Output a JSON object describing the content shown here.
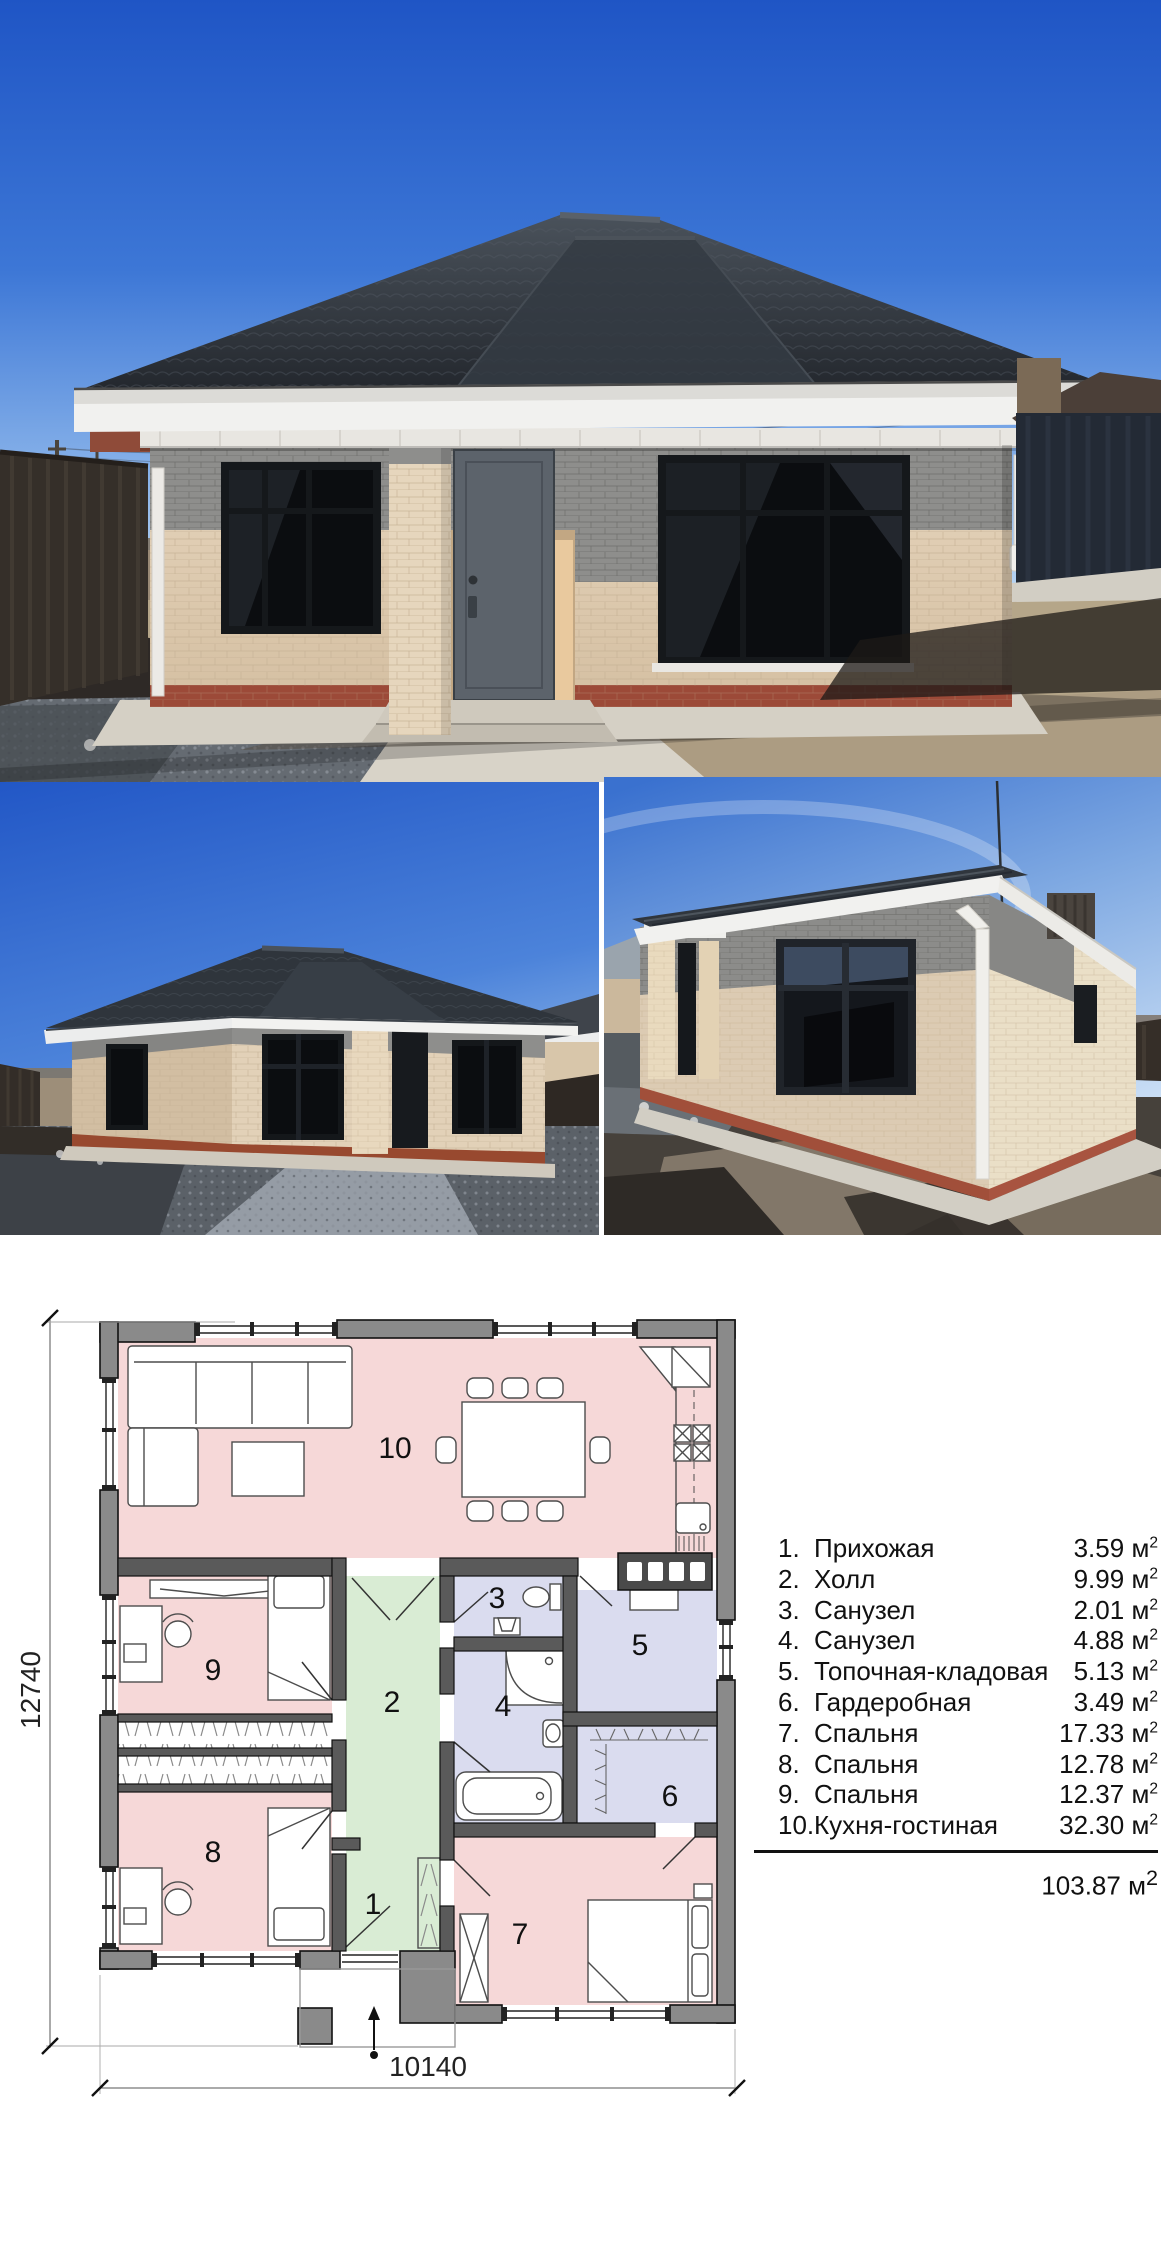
{
  "plan": {
    "room_numbers": [
      "1",
      "2",
      "3",
      "4",
      "5",
      "6",
      "7",
      "8",
      "9",
      "10"
    ],
    "dimensions": {
      "width_label": "10140",
      "height_label": "12740"
    }
  },
  "legend": {
    "items": [
      {
        "num": "1.",
        "name": "Прихожая",
        "area": "3.59"
      },
      {
        "num": "2.",
        "name": "Холл",
        "area": "9.99"
      },
      {
        "num": "3.",
        "name": "Санузел",
        "area": "2.01"
      },
      {
        "num": "4.",
        "name": "Санузел",
        "area": "4.88"
      },
      {
        "num": "5.",
        "name": "Топочная-кладовая",
        "area": "5.13"
      },
      {
        "num": "6.",
        "name": "Гардеробная",
        "area": "3.49"
      },
      {
        "num": "7.",
        "name": "Спальня",
        "area": "17.33"
      },
      {
        "num": "8.",
        "name": "Спальня",
        "area": "12.78"
      },
      {
        "num": "9.",
        "name": "Спальня",
        "area": "12.37"
      },
      {
        "num": "10.",
        "name": "Кухня-гостиная",
        "area": "32.30"
      }
    ],
    "unit": "м",
    "unit_sup": "2",
    "total": "103.87"
  },
  "colors": {
    "plan_room_pink": "#f6d8d8",
    "plan_room_green": "#d9ecd4",
    "plan_room_lavender": "#dadcef",
    "plan_wall_gray": "#8a8a8a",
    "photo_sky_blue": "#2a5fd0",
    "brick_beige": "#decaae",
    "brick_gray_band": "#8e8e8c",
    "roof_dark": "#2e343b",
    "plinth_red": "#9c4a38"
  }
}
